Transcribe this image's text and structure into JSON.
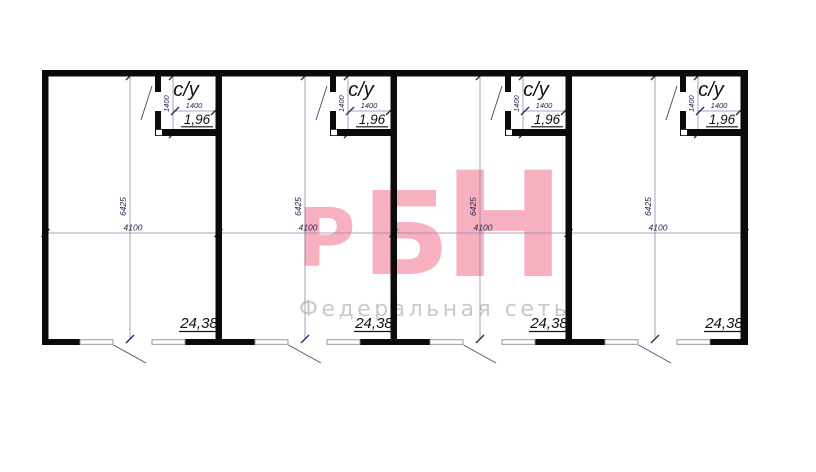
{
  "watermark": {
    "letters": [
      "Р",
      "Б",
      "Н"
    ],
    "subtitle": "Федеральная сеть",
    "accent_color": "#f6b0c0",
    "subtitle_color": "#c9c9c9"
  },
  "plan": {
    "wall_color": "#0b0b0b",
    "dim_line_color": "#8a8aac",
    "units": [
      {
        "bathroom_label": "с/у",
        "bathroom_width_mm": "1400",
        "bathroom_depth_mm": "1400",
        "bathroom_area_m2": "1,96",
        "room_area_m2": "24,38",
        "unit_width_mm": "4100",
        "unit_height_mm": "6425"
      },
      {
        "bathroom_label": "с/у",
        "bathroom_width_mm": "1400",
        "bathroom_depth_mm": "1400",
        "bathroom_area_m2": "1,96",
        "room_area_m2": "24,38",
        "unit_width_mm": "4100",
        "unit_height_mm": "6425"
      },
      {
        "bathroom_label": "с/у",
        "bathroom_width_mm": "1400",
        "bathroom_depth_mm": "1400",
        "bathroom_area_m2": "1,96",
        "room_area_m2": "24,38",
        "unit_width_mm": "4100",
        "unit_height_mm": "6425"
      },
      {
        "bathroom_label": "с/у",
        "bathroom_width_mm": "1400",
        "bathroom_depth_mm": "1400",
        "bathroom_area_m2": "1,96",
        "room_area_m2": "24,38",
        "unit_width_mm": "4100",
        "unit_height_mm": "6425"
      }
    ]
  }
}
